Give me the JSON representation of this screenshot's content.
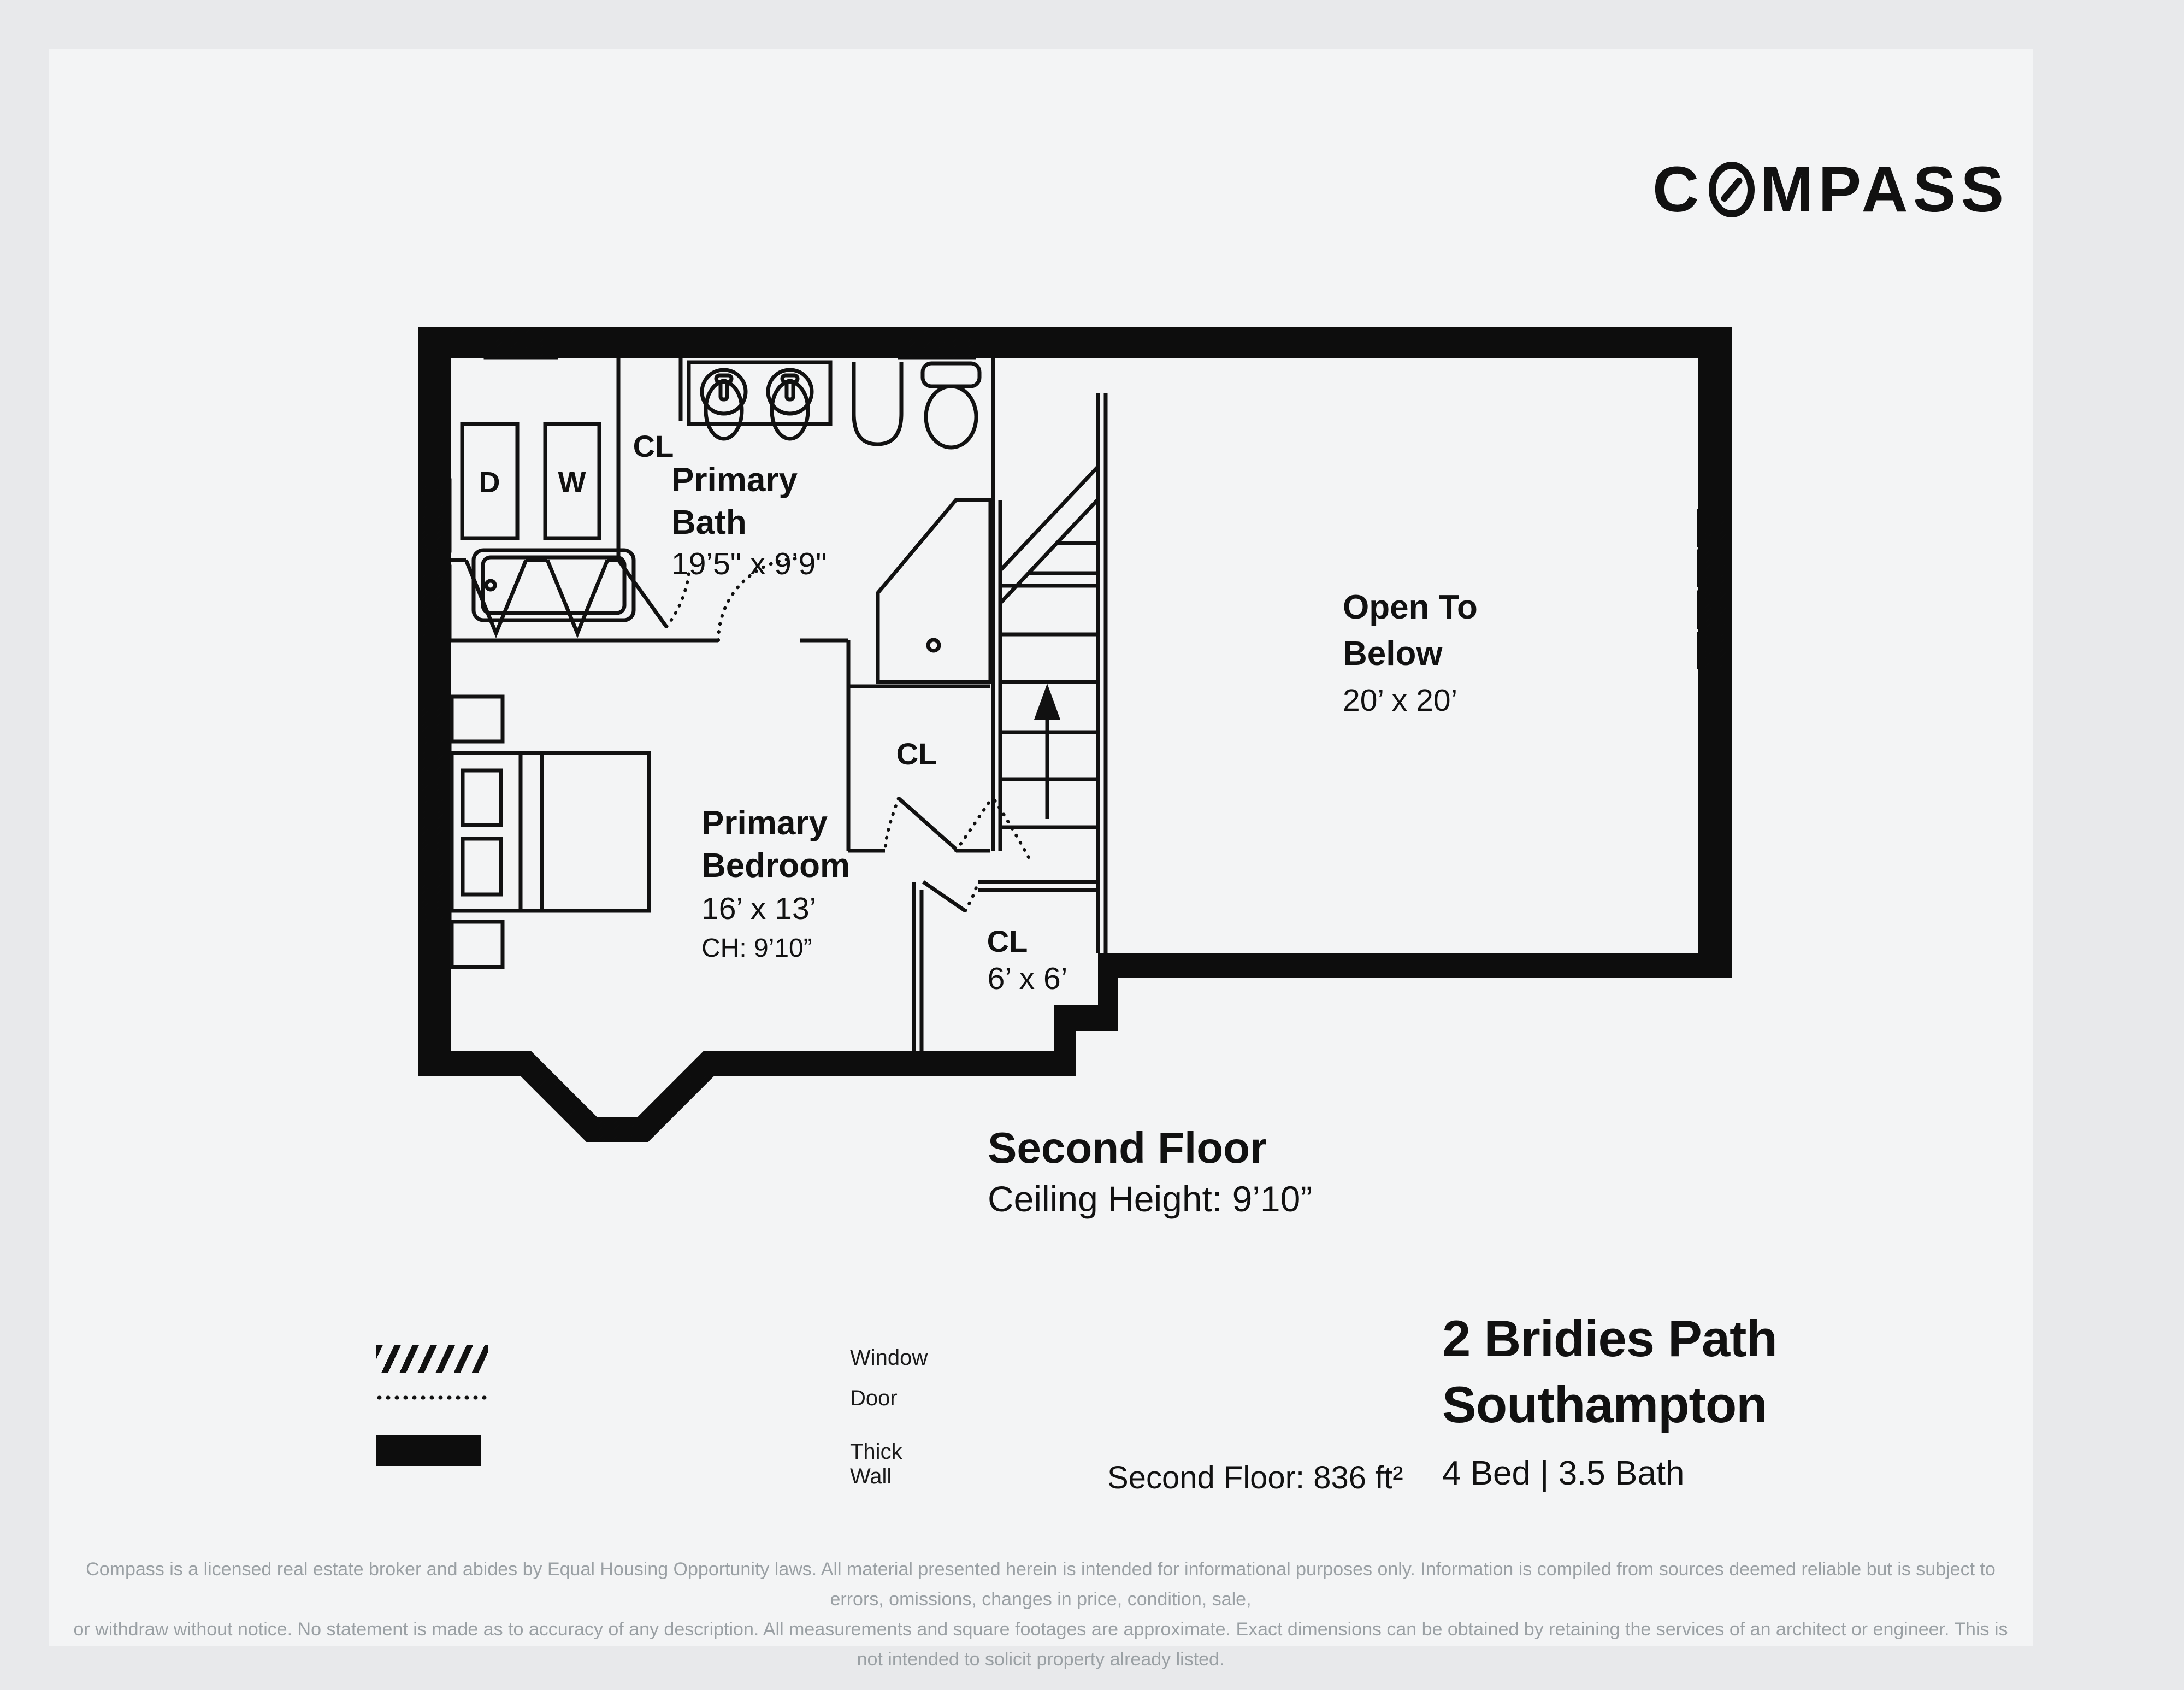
{
  "logo": {
    "pre": "C",
    "post": "MPASS",
    "full": "COMPASS"
  },
  "plan": {
    "rooms": {
      "bath": {
        "line1": "Primary",
        "line2": "Bath",
        "dims": "19’5\" x 9’9\""
      },
      "bedroom": {
        "line1": "Primary",
        "line2": "Bedroom",
        "dims": "16’ x 13’",
        "ch": "CH: 9’10”"
      },
      "open": {
        "line1": "Open To",
        "line2": "Below",
        "dims": "20’ x 20’"
      },
      "cl_top": "CL",
      "cl_mid": "CL",
      "cl6": {
        "label": "CL",
        "dims": "6’ x 6’"
      },
      "dryer": "D",
      "washer": "W"
    }
  },
  "floor": {
    "title": "Second Floor",
    "ceiling": "Ceiling Height: 9’10”",
    "area": "Second Floor: 836 ft²"
  },
  "legend": {
    "window": "Window",
    "door": "Door",
    "thick_wall": "Thick Wall"
  },
  "listing": {
    "address_line1": "2 Bridies Path",
    "address_line2": "Southampton",
    "beds_baths": "4 Bed | 3.5 Bath"
  },
  "disclaimer": {
    "line1": "Compass is a licensed real estate broker and abides by Equal Housing Opportunity laws. All material presented herein is intended for informational purposes only. Information is compiled from sources deemed reliable but is subject to errors, omissions, changes in price, condition, sale,",
    "line2": "or withdraw without notice. No statement is made as to accuracy of any description. All measurements and square footages are approximate. Exact dimensions can be obtained by retaining the services of an architect or engineer. This is not intended to solicit property already listed."
  }
}
